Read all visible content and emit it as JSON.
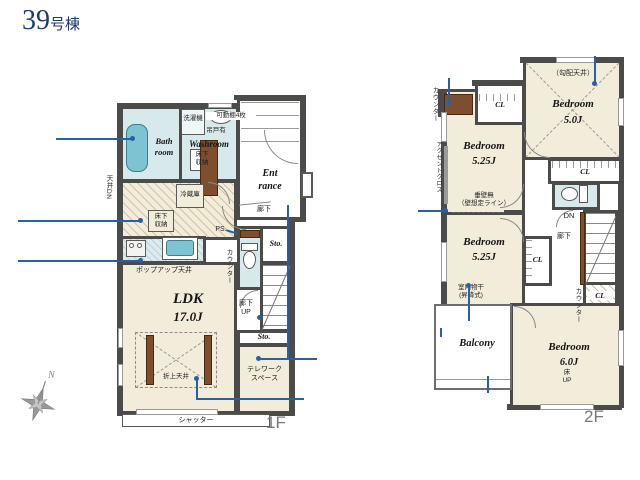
{
  "title": {
    "number": "39",
    "suffix": "号棟"
  },
  "compass": {
    "north": "N"
  },
  "colors": {
    "wall": "#4b4b49",
    "floor": "#f2edda",
    "wet_area": "#d8e9ec",
    "fixture": "#7ec3d1",
    "wood": "#7d4f2e",
    "annotation": "#2b5fa5",
    "title": "#1d3a6e"
  },
  "floor1": {
    "floor_label": "1F",
    "bath": "Bath\nroom",
    "washroom": "Washroom",
    "washer": "洗濯機",
    "hanging_cabinet": "吊戸有",
    "movable_shelves": "可動棚4枚",
    "underfloor_a": "床下\n収納",
    "underfloor_b": "床下\n収納",
    "fridge": "冷蔵庫",
    "ceiling_dn": "天井DN",
    "entrance": "Ent\nrance",
    "hallway": "廊下",
    "ps": "PS.",
    "counter": "カウンター",
    "sto_a": "Sto.",
    "sto_b": "Sto.",
    "stairs_up": "廊下\nUP",
    "popup_ceiling": "ポップアップ天井",
    "ldk_name": "LDK",
    "ldk_size": "17.0J",
    "coffered_ceiling": "折上天井",
    "telework": "テレワーク\nスペース",
    "shutter": "シャッター"
  },
  "floor2": {
    "floor_label": "2F",
    "counter_top": "カウンター",
    "cl_top": "CL",
    "sloped_ceiling": "（勾配天井）",
    "bedroom_a_name": "Bedroom",
    "bedroom_a_size": "5.0J",
    "cl_right": "CL",
    "no_drop_wall": "垂壁無\n（壁想定ライン）",
    "bedroom_b_name": "Bedroom",
    "bedroom_b_size": "5.25J",
    "accent_cloth": "アクセントクロス",
    "bedroom_c_name": "Bedroom",
    "bedroom_c_size": "5.25J",
    "indoor_drying": "室内物干\n(昇降式)",
    "dn": "DN",
    "hallway": "廊下",
    "cl_left": "CL",
    "counter_bottom": "カウンター",
    "cl_bottom": "CL",
    "balcony": "Balcony",
    "bedroom_d_name": "Bedroom",
    "bedroom_d_size": "6.0J",
    "floor_up": "床\nUP"
  }
}
